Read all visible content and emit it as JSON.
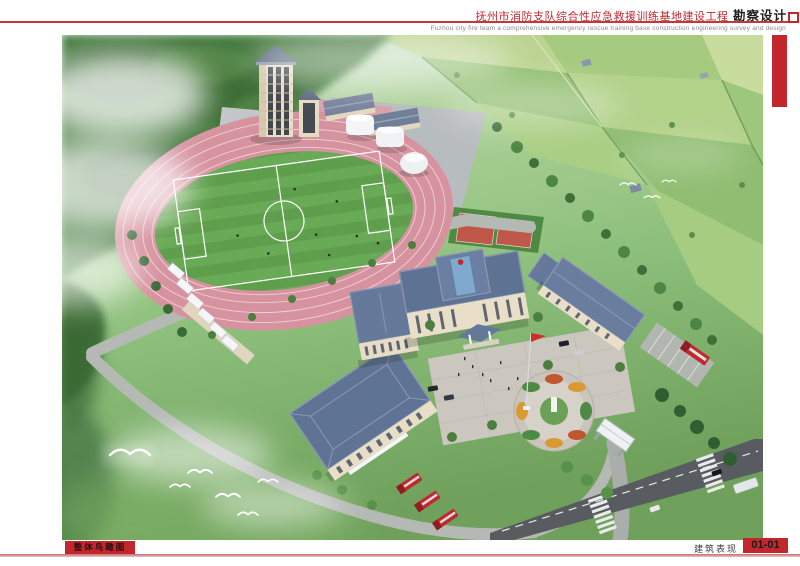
{
  "header": {
    "title_cn": "抚州市消防支队综合性应急救援训练基地建设工程",
    "title_suffix_cn": "勘察设计",
    "subtitle_en": "Fuzhou city fire team a comprehensive emergency rescue training base construction engineering survey and design"
  },
  "footer": {
    "view_label": "整体鸟瞰图",
    "category_label": "建筑表现",
    "sheet_number": "01-01"
  },
  "colors": {
    "accent_red": "#c1272d",
    "divider_pink": "#c96a6a",
    "track_pink": "#d6929e",
    "field_green": "#5f9e4c",
    "roof_blue": "#64789a"
  }
}
